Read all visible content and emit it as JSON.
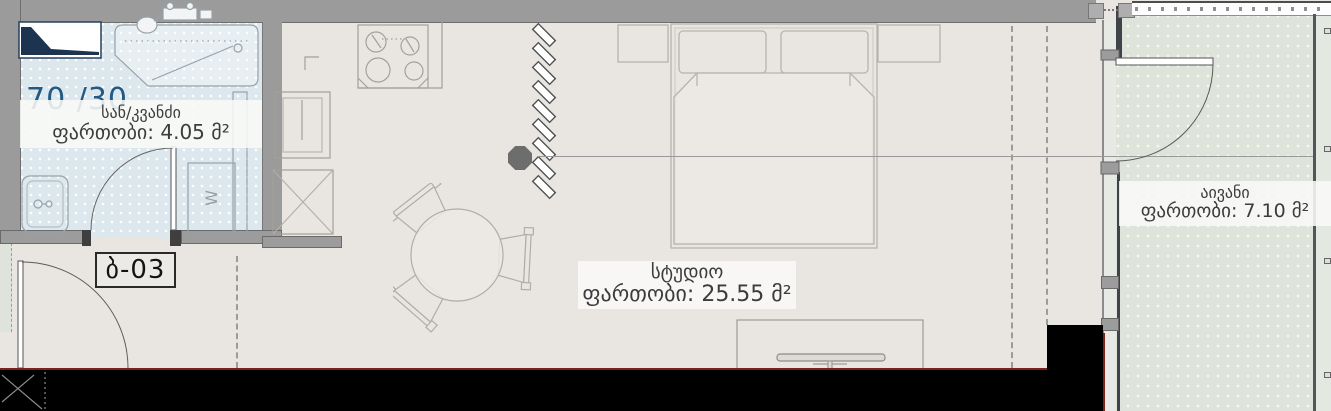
{
  "header": {
    "ratio_label": "70 /30",
    "unit_label": "ბ-03"
  },
  "rooms": {
    "bathroom": {
      "name": "სან/კვანძი",
      "area": "ფართობი: 4.05 მ²"
    },
    "studio": {
      "name": "სტუდიო",
      "area": "ფართობი: 25.55 მ²"
    },
    "balcony": {
      "name": "აივანი",
      "area": "ფართობი: 7.10 მ²"
    }
  },
  "fixtures": {
    "washer_label": "W"
  },
  "colors": {
    "wall_gray": "#9b9b9b",
    "studio_floor": "#e9e6e2",
    "bathroom_floor": "#dde8ee",
    "balcony_floor": "#dfe4da",
    "accent_blue": "#225a85",
    "structure_black": "#000000",
    "boundary_red": "#7c2319"
  }
}
